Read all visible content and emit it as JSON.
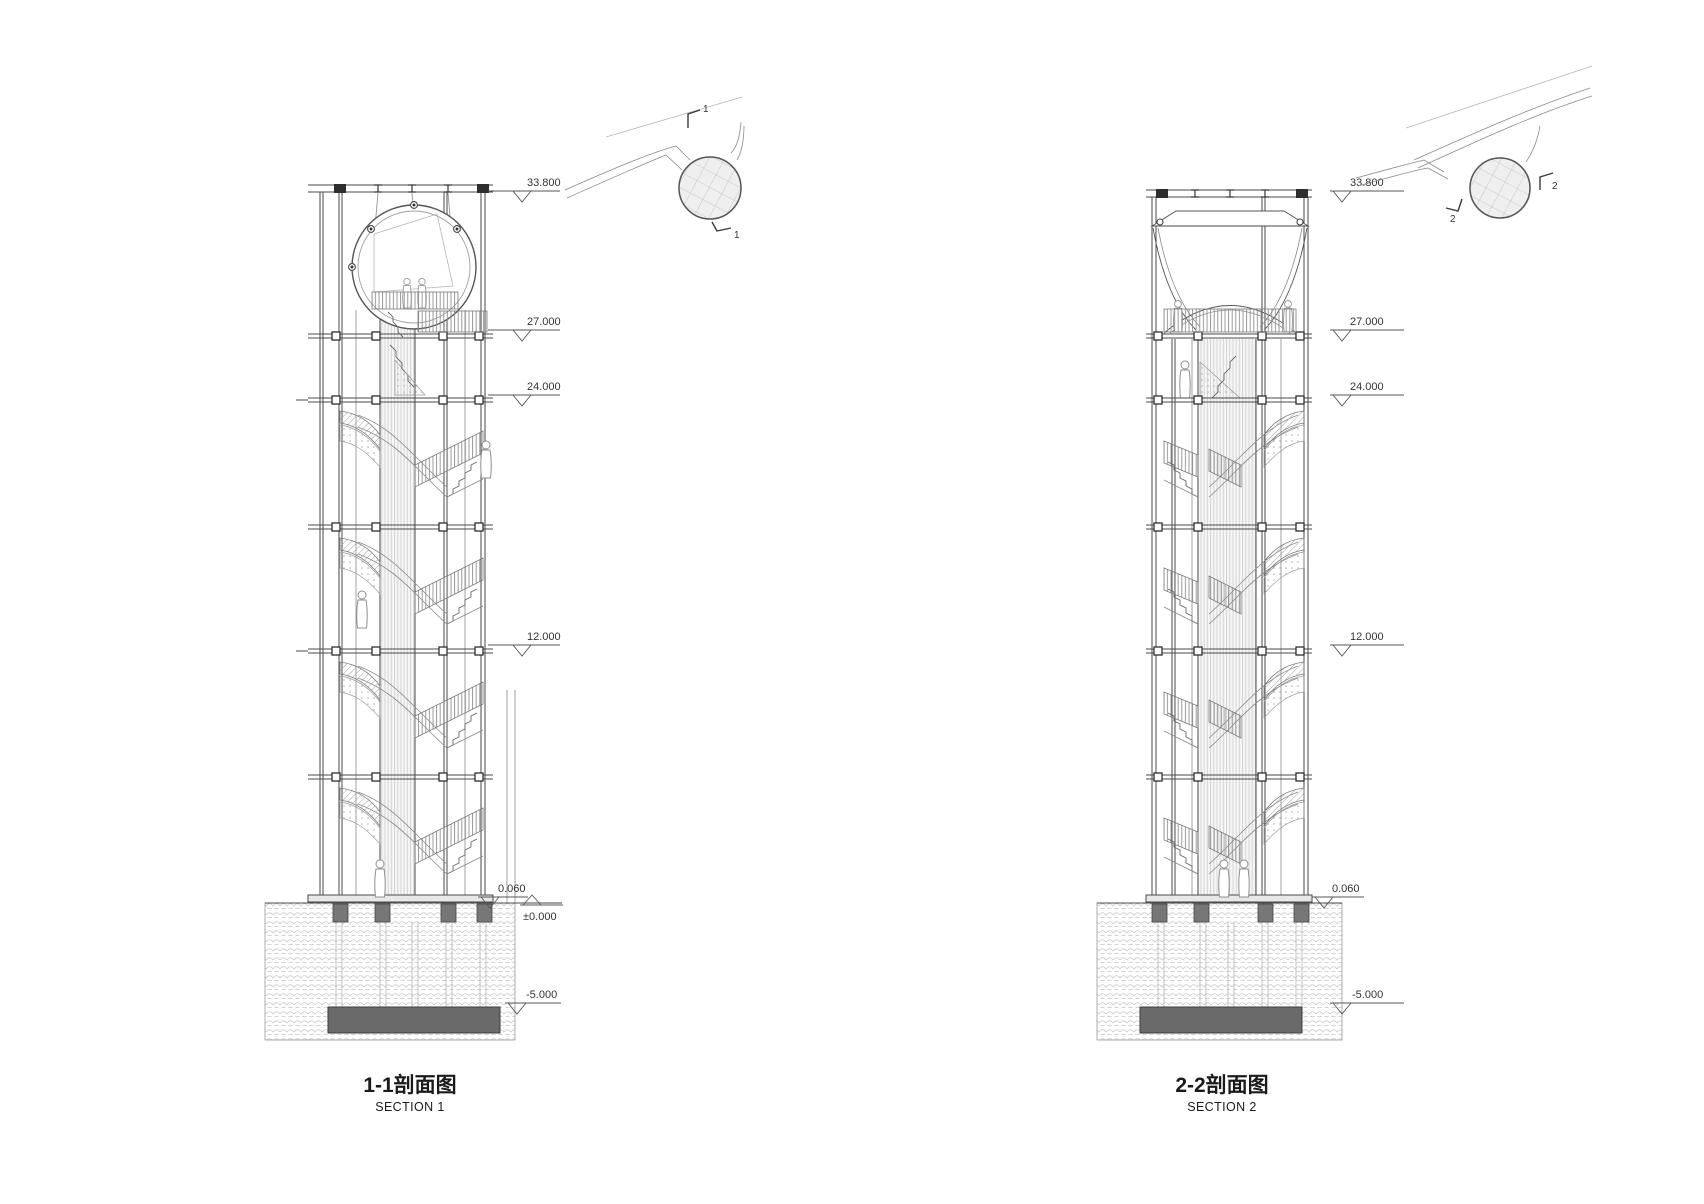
{
  "page": {
    "background": "#ffffff"
  },
  "left_section": {
    "title_cn": "1-1剖面图",
    "title_en": "SECTION 1",
    "elevations": {
      "e338": "33.800",
      "e27": "27.000",
      "e24": "24.000",
      "e12": "12.000",
      "e006": "0.060",
      "ezero": "±0.000",
      "em5": "-5.000"
    },
    "key_plan": {
      "cut_top": "1",
      "cut_bottom": "1"
    }
  },
  "right_section": {
    "title_cn": "2-2剖面图",
    "title_en": "SECTION 2",
    "elevations": {
      "e338": "33.800",
      "e27": "27.000",
      "e24": "24.000",
      "e12": "12.000",
      "e006": "0.060",
      "em5": "-5.000"
    },
    "key_plan": {
      "cut_right": "2",
      "cut_left": "2"
    }
  },
  "colors": {
    "line": "#4a4a4a",
    "light_line": "#9e9e9e",
    "slab": "#6a6a6a",
    "soil_hatch": "#c6c6c6",
    "text": "#333333"
  }
}
